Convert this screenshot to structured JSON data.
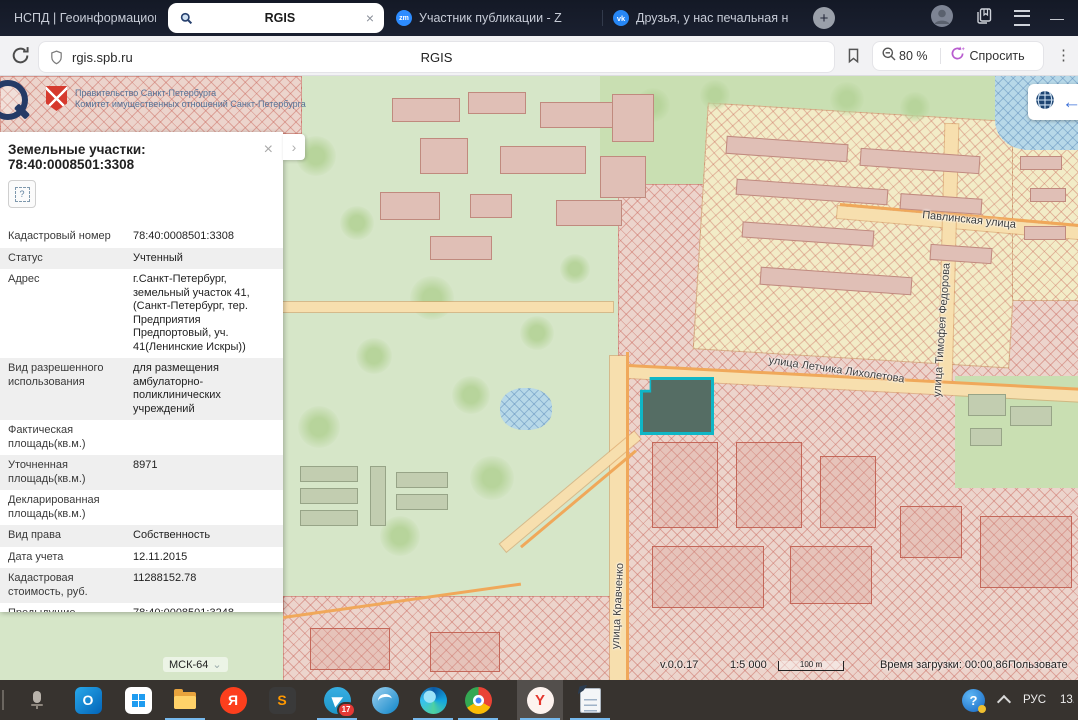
{
  "icons": {
    "close": "×",
    "chevron_right": "›",
    "kebab": "⋮",
    "plus": "+",
    "minimize": "—",
    "caret_down": "⌄",
    "arrow_left": "←",
    "question": "?"
  },
  "browser": {
    "tabs": [
      {
        "title": "НСПД | Геоинформацион",
        "icon": ""
      },
      {
        "title": "RGIS",
        "icon": "magnifier"
      },
      {
        "title": "Участник публикации - Z",
        "icon": "zm",
        "icon_label": "zm"
      },
      {
        "title": "Друзья, у нас печальная н",
        "icon": "vk",
        "icon_label": "vk"
      }
    ],
    "address": {
      "url": "rgis.spb.ru",
      "page_title": "RGIS",
      "zoom_level": "80 %",
      "ask_label": "Спросить"
    }
  },
  "map": {
    "gov_header": {
      "line1": "Правительство Санкт-Петербурга",
      "line2": "Комитет имущественных отношений Санкт-Петербурга"
    },
    "street_labels": [
      "Павлинская улица",
      "улица Тимофея Федорова",
      "улица Летчика Лихолетова",
      "улица Кравченко"
    ],
    "statusbar": {
      "crs": "МСК-64",
      "version": "v.0.0.17",
      "scale": "1:5 000",
      "scalebar_label": "100 m",
      "load_time": "Время загрузки: 00:00,86",
      "user_label": "Пользовате"
    }
  },
  "panel": {
    "title": "Земельные участки: 78:40:0008501:3308",
    "rows": [
      {
        "label": "Кадастровый номер",
        "value": "78:40:0008501:3308"
      },
      {
        "label": "Статус",
        "value": "Учтенный"
      },
      {
        "label": "Адрес",
        "value": "г.Санкт-Петербург, земельный участок 41, (Санкт-Петербург, тер. Предприятия Предпортовый, уч. 41(Ленинские Искры))"
      },
      {
        "label": "Вид разрешенного использования",
        "value": "для размещения амбулаторно-поликлинических учреждений"
      },
      {
        "label": "Фактическая площадь(кв.м.)",
        "value": ""
      },
      {
        "label": "Уточненная площадь(кв.м.)",
        "value": "8971"
      },
      {
        "label": "Декларированная площадь(кв.м.)",
        "value": ""
      },
      {
        "label": "Вид права",
        "value": "Собственность"
      },
      {
        "label": "Дата учета",
        "value": "12.11.2015"
      },
      {
        "label": "Кадастровая стоимость, руб.",
        "value": "11288152.78"
      },
      {
        "label": "Предыдущие кадастровые номера",
        "value": "78:40:0008501:3248, 78:40:0008501:3263"
      },
      {
        "label": "Кадастровый № до 27.08.2012",
        "value": ""
      },
      {
        "label": "Есть кадастровая съёмка?",
        "value": "Да"
      },
      {
        "label": "Информация об аренде",
        "value": "В аренде"
      }
    ]
  },
  "taskbar": {
    "icons": [
      "voice-recorder",
      "outlook",
      "microsoft-store",
      "file-explorer",
      "yandex",
      "sublime-text",
      "telegram",
      "openoffice",
      "edge",
      "chrome",
      "yandex-browser",
      "text-document"
    ],
    "letters": {
      "outlook": "O",
      "yandex": "Я",
      "sublime": "S",
      "ybrowser": "Y"
    },
    "telegram_badge": "17",
    "tray": {
      "lang": "РУС",
      "clock": "13.1"
    }
  }
}
